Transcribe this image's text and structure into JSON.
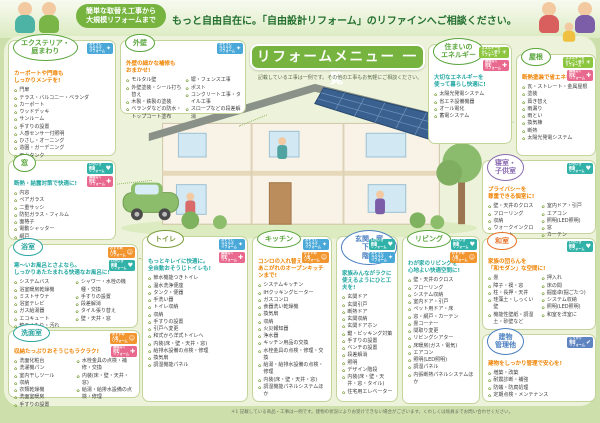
{
  "header": {
    "bubble": "簡単な取替え工事から\n大規模リフォームまで",
    "headline": "もっと自由自在に。「自由設計リフォーム」のリファインへご相談ください。"
  },
  "menu": {
    "title": "リフォームメニュー 一覧",
    "note": "記載している工事は一例です。その他の工事もお気軽にご相談ください。"
  },
  "footnote": "＊1 記載している商品・工事は一例です。建物の状況によりお受けできない場合がございます。くわしくは係員までお問い合わせください。",
  "bullet_glyph": "✿",
  "badge_types": {
    "sukkiri": {
      "label": "おそうじ\nラクラク\nリフォーム",
      "color": "#49a8d8",
      "icon": "✦",
      "icon_name": "sparkle-icon"
    },
    "osusume": {
      "label": "おすすめ\n人気\nリフォーム",
      "color": "#f2952f",
      "icon": "☺",
      "icon_name": "smiley-icon"
    },
    "kenko": {
      "label": "いきいき\n健康\nリフォーム",
      "color": "#31b2a9",
      "icon": "♥",
      "icon_name": "heart-icon"
    },
    "energy": {
      "label": "エネルギーを\nかしこく使う\nリフォーム",
      "color": "#8cc63f",
      "icon": "☀",
      "icon_name": "sun-icon"
    },
    "bohan": {
      "label": "無理なく\n防犯\nリフォーム",
      "color": "#e9688e",
      "icon": "✚",
      "icon_name": "cross-icon"
    },
    "kanri": {
      "label": "しっかり\n管理\nリフォーム",
      "color": "#5d83c0",
      "icon": "✔",
      "icon_name": "check-icon"
    }
  },
  "boxes": {
    "exterior": {
      "title": "エクステリア・\n庭まわり",
      "color": "#5aa53c",
      "tagline": "カーポートや門扉も\nしっかりメンテを!",
      "tagline_color": "#ef8200",
      "badges": [
        "sukkiri"
      ],
      "items": [
        "門扉",
        "テラス・バルコニー・ベランダ",
        "カーポート",
        "ウッドデッキ",
        "サンルーム",
        "手すりの設置",
        "人感センサー付照明",
        "ひさし・オーニング",
        "造園・ガーデニング",
        "雨水タンク"
      ]
    },
    "wall": {
      "title": "外壁",
      "color": "#5aa53c",
      "tagline": "外壁の細かな補修も\nおまかせ!",
      "tagline_color": "#ef8200",
      "badges": [
        "sukkiri"
      ],
      "items": [
        "モルタル壁",
        "外壁塗装・シール打ち替え",
        "木製・鉄製の塗装",
        "ベランダなどの防水・トップコート塗布",
        "塀・フェンス工事",
        "ポスト",
        "コンクリート工事・タイル工事",
        "スロープなどの段差解消"
      ]
    },
    "window": {
      "title": "窓",
      "color": "#5aa53c",
      "tagline": "断熱・結露対策で快適に!",
      "tagline_color": "#1fa6a0",
      "badges": [
        "kenko",
        "bohan"
      ],
      "items": [
        "内窓",
        "ペアガラス",
        "二重サッシ",
        "防犯ガラス・フィルム",
        "面格子",
        "電動シャッター",
        "網戸"
      ]
    },
    "bath": {
      "title": "浴室",
      "color": "#2ba5a0",
      "tagline": "寒〜いお風呂とさよなら。\nしっかりあたたまれる快適なお風呂に!",
      "tagline_color": "#1fa6a0",
      "badges": [
        "osusume",
        "kenko"
      ],
      "items": [
        "システムバス",
        "浴室暖房乾燥機",
        "ミストサウナ",
        "浴室テレビ",
        "ガス給湯器",
        "エコキュート",
        "鏡のくもり・汚れ",
        "シャワー・水栓の機種・交換",
        "手すりの設置",
        "段差解消",
        "タイル張り替え",
        "壁・天井・窓"
      ]
    },
    "washroom": {
      "title": "洗面室",
      "color": "#2ba5a0",
      "tagline": "収納たっぷりおそうじもラクラク!",
      "tagline_color": "#ef8200",
      "badges": [
        "osusume",
        "bohan"
      ],
      "items": [
        "洗面化粧台",
        "洗濯機パン",
        "室内干しツール",
        "収納",
        "衣類乾燥機",
        "洗面室暖房",
        "手すりの設置",
        "水栓金具の点検・補修・交換",
        "内装(床・壁・天井・窓)",
        "給湯・給排水設備の点検・修理"
      ]
    },
    "toilet": {
      "title": "トイレ",
      "color": "#7a9a3a",
      "tagline": "もっとキレイに快適に。\n全自動おそうじトイレも!",
      "tagline_color": "#1fa6a0",
      "badges": [
        "sukkiri",
        "bohan"
      ],
      "items": [
        "節水機能つきトイレ",
        "温水洗浄便座",
        "タンク・便器",
        "手洗い器",
        "トイレ収納",
        "収納",
        "手すりの設置",
        "引戸へ変更",
        "和式から洋式トイレへ",
        "内装(床・壁・天井・窓)",
        "給排水設備の点検・修理",
        "換気扇",
        "調湿機能パネル"
      ]
    },
    "kitchen": {
      "title": "キッチン",
      "color": "#5aa53c",
      "tagline": "コンロの入れ替えから\nあこがれのオープンキッチンまで!",
      "tagline_color": "#ef8200",
      "badges": [
        "sukkiri",
        "osusume"
      ],
      "items": [
        "システムキッチン",
        "IHクッキングヒーター",
        "ガスコンロ",
        "食器洗い乾燥機",
        "換気扇",
        "収納",
        "火災報知器",
        "浄水器",
        "キッチン用品の交換",
        "水栓金具の点検・修理・交換",
        "給湯・給排水設備の点検・修理",
        "内装(床・壁・天井・窓)",
        "調湿機能パネルシステムほか"
      ]
    },
    "entrance": {
      "title": "玄関・廊下・\n階段",
      "color": "#4a7fc1",
      "tagline": "家族みんながラクに\n使えるようにひと工夫を!",
      "tagline_color": "#1fa6a0",
      "badges": [
        "kenko",
        "sukkiri"
      ],
      "items": [
        "玄関ドア",
        "玄関引戸",
        "断熱ドア",
        "玄関収納",
        "玄関ドアホン",
        "鍵・ピッキング対策",
        "手すりの設置",
        "ベンチの設置",
        "段差解消",
        "照明",
        "デザイン階段",
        "内装(床・壁・天井・窓・タイル)",
        "住宅用エレベーター"
      ]
    },
    "living": {
      "title": "リビング",
      "color": "#5aa53c",
      "tagline": "わが家のリビングを\n心地よい快適空間に!",
      "tagline_color": "#1fa6a0",
      "badges": [
        "kenko",
        "osusume"
      ],
      "items": [
        "壁・天井のクロス",
        "フローリング",
        "システム収納",
        "室内ドア・引戸",
        "ペット用ドア・床",
        "窓・網戸・カーテン",
        "畳コーナー",
        "間取り変更",
        "リビングシアター",
        "床暖房(ガス・電気)",
        "エアコン",
        "照明(LED照明)",
        "調湿パネル",
        "内張断熱パネルシステムほか"
      ]
    },
    "energy": {
      "title": "住まいの\nエネルギー",
      "color": "#5aa53c",
      "tagline": "大切なエネルギーを\n使って暮らし快適に!",
      "tagline_color": "#1fa6a0",
      "badges": [
        "energy",
        "bohan"
      ],
      "items": [
        "太陽光発電システム",
        "省エネ設備機器",
        "オール電化",
        "蓄電システム"
      ]
    },
    "roof": {
      "title": "屋根",
      "color": "#5aa53c",
      "tagline": "断熱塗装で省エネも!",
      "tagline_color": "#ef8200",
      "badges": [
        "energy",
        "bohan"
      ],
      "items": [
        "瓦・ストレート・金属屋根",
        "塗装",
        "葺き替え",
        "雨漏り",
        "雨とい",
        "換気棟",
        "断熱",
        "太陽光発電システム"
      ]
    },
    "bedroom": {
      "title": "寝室・\n子供室",
      "color": "#8a6bb0",
      "tagline": "プライバシーを\n尊重できる個室に!",
      "tagline_color": "#ef8200",
      "badges": [
        "kenko"
      ],
      "items": [
        "壁・天井のクロス",
        "フローリング",
        "収納",
        "ウォークインクローゼット",
        "内張断熱パネルシステムほか",
        "室内ドア・引戸",
        "エアコン",
        "照明(LED照明)",
        "窓",
        "カーテン"
      ]
    },
    "washitsu": {
      "title": "和室",
      "color": "#e8732a",
      "tagline": "家族の団らんを\n「和モダン」な空間に!",
      "tagline_color": "#ef8200",
      "badges": [
        "kenko"
      ],
      "items": [
        "畳",
        "障子・襖・窓",
        "柱・長押・天井",
        "珪藻土・しっくい壁",
        "機能性壁紙・調湿土・砂壁など",
        "押入れ",
        "床の間",
        "掘座卓(掘ごたつ)",
        "システム収納",
        "照明(LED照明)",
        "和室を洋室に"
      ]
    },
    "building": {
      "title": "建物\n管理他",
      "color": "#4a7fc1",
      "tagline": "建物をしっかり管理で安心を!",
      "tagline_color": "#ef8200",
      "badges": [
        "kanri"
      ],
      "items": [
        "増築・改築",
        "耐震診断・補強",
        "防蟻・防腐処理",
        "定期点検・メンテナンス"
      ]
    }
  }
}
